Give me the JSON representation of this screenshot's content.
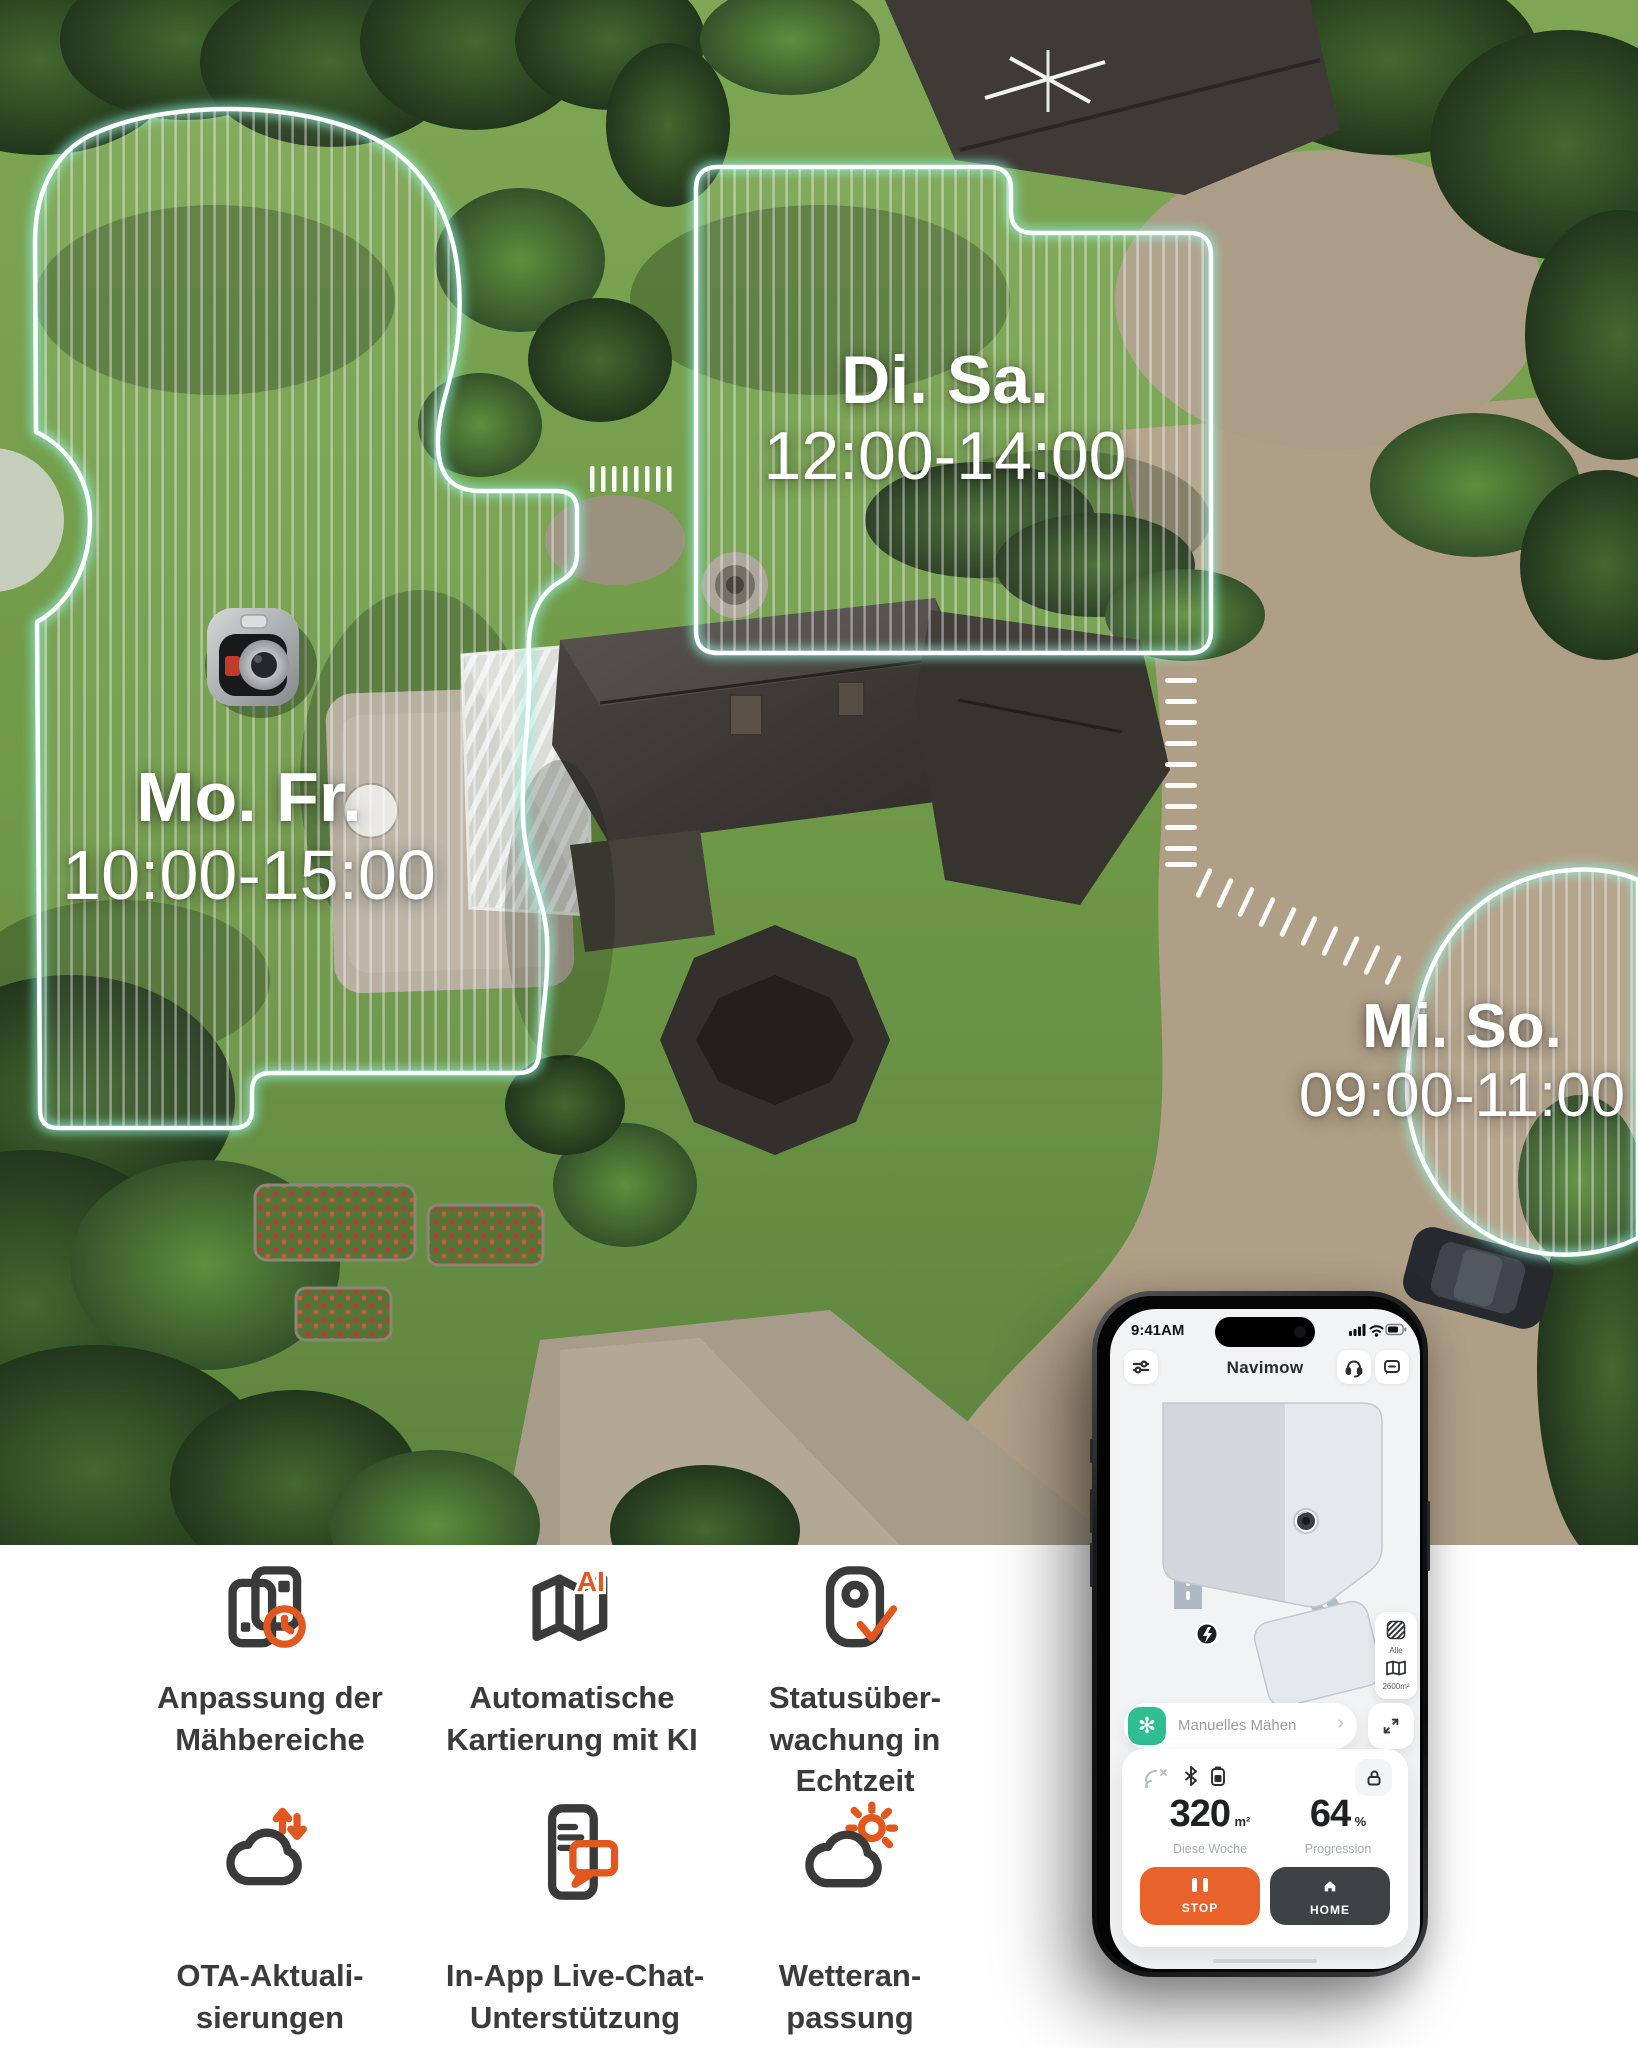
{
  "aerial": {
    "zones": [
      {
        "id": "zone-mo-fr",
        "days": "Mo. Fr.",
        "time": "10:00-15:00"
      },
      {
        "id": "zone-di-sa",
        "days": "Di. Sa.",
        "time": "12:00-14:00"
      },
      {
        "id": "zone-mi-so",
        "days": "Mi. So.",
        "time": "09:00-11:00"
      }
    ]
  },
  "phone": {
    "status_time": "9:41AM",
    "title": "Navimow",
    "map_controls": {
      "all_label": "Alle",
      "area_label": "2600m²"
    },
    "mode": {
      "label": "Manuelles Mähen",
      "chevron": "›"
    },
    "stats": {
      "week_value": "320",
      "week_unit": "m²",
      "week_caption": "Diese Woche",
      "progress_value": "64",
      "progress_unit": "%",
      "progress_caption": "Progression"
    },
    "actions": {
      "stop": "STOP",
      "home": "HOME"
    }
  },
  "features": [
    {
      "icon": "map-clock-icon",
      "lines": [
        "Anpassung der",
        "Mähbereiche"
      ]
    },
    {
      "icon": "ai-map-icon",
      "lines": [
        "Automatische",
        "Kartierung mit KI"
      ]
    },
    {
      "icon": "status-monitor-icon",
      "lines": [
        "Statusüber-",
        "wachung in",
        "Echtzeit"
      ]
    },
    {
      "icon": "ota-cloud-icon",
      "lines": [
        "OTA-Aktuali-",
        "sierungen"
      ]
    },
    {
      "icon": "live-chat-icon",
      "lines": [
        "In-App Live-Chat-",
        "Unterstützung"
      ]
    },
    {
      "icon": "weather-cloud-icon",
      "lines": [
        "Wetteran-",
        "passung"
      ]
    }
  ],
  "colors": {
    "icon_dark": "#3A3A3A",
    "icon_orange": "#E2571D",
    "app_orange": "#E8622B",
    "app_dark_button": "#3E4245",
    "app_green": "#2EBE92"
  }
}
